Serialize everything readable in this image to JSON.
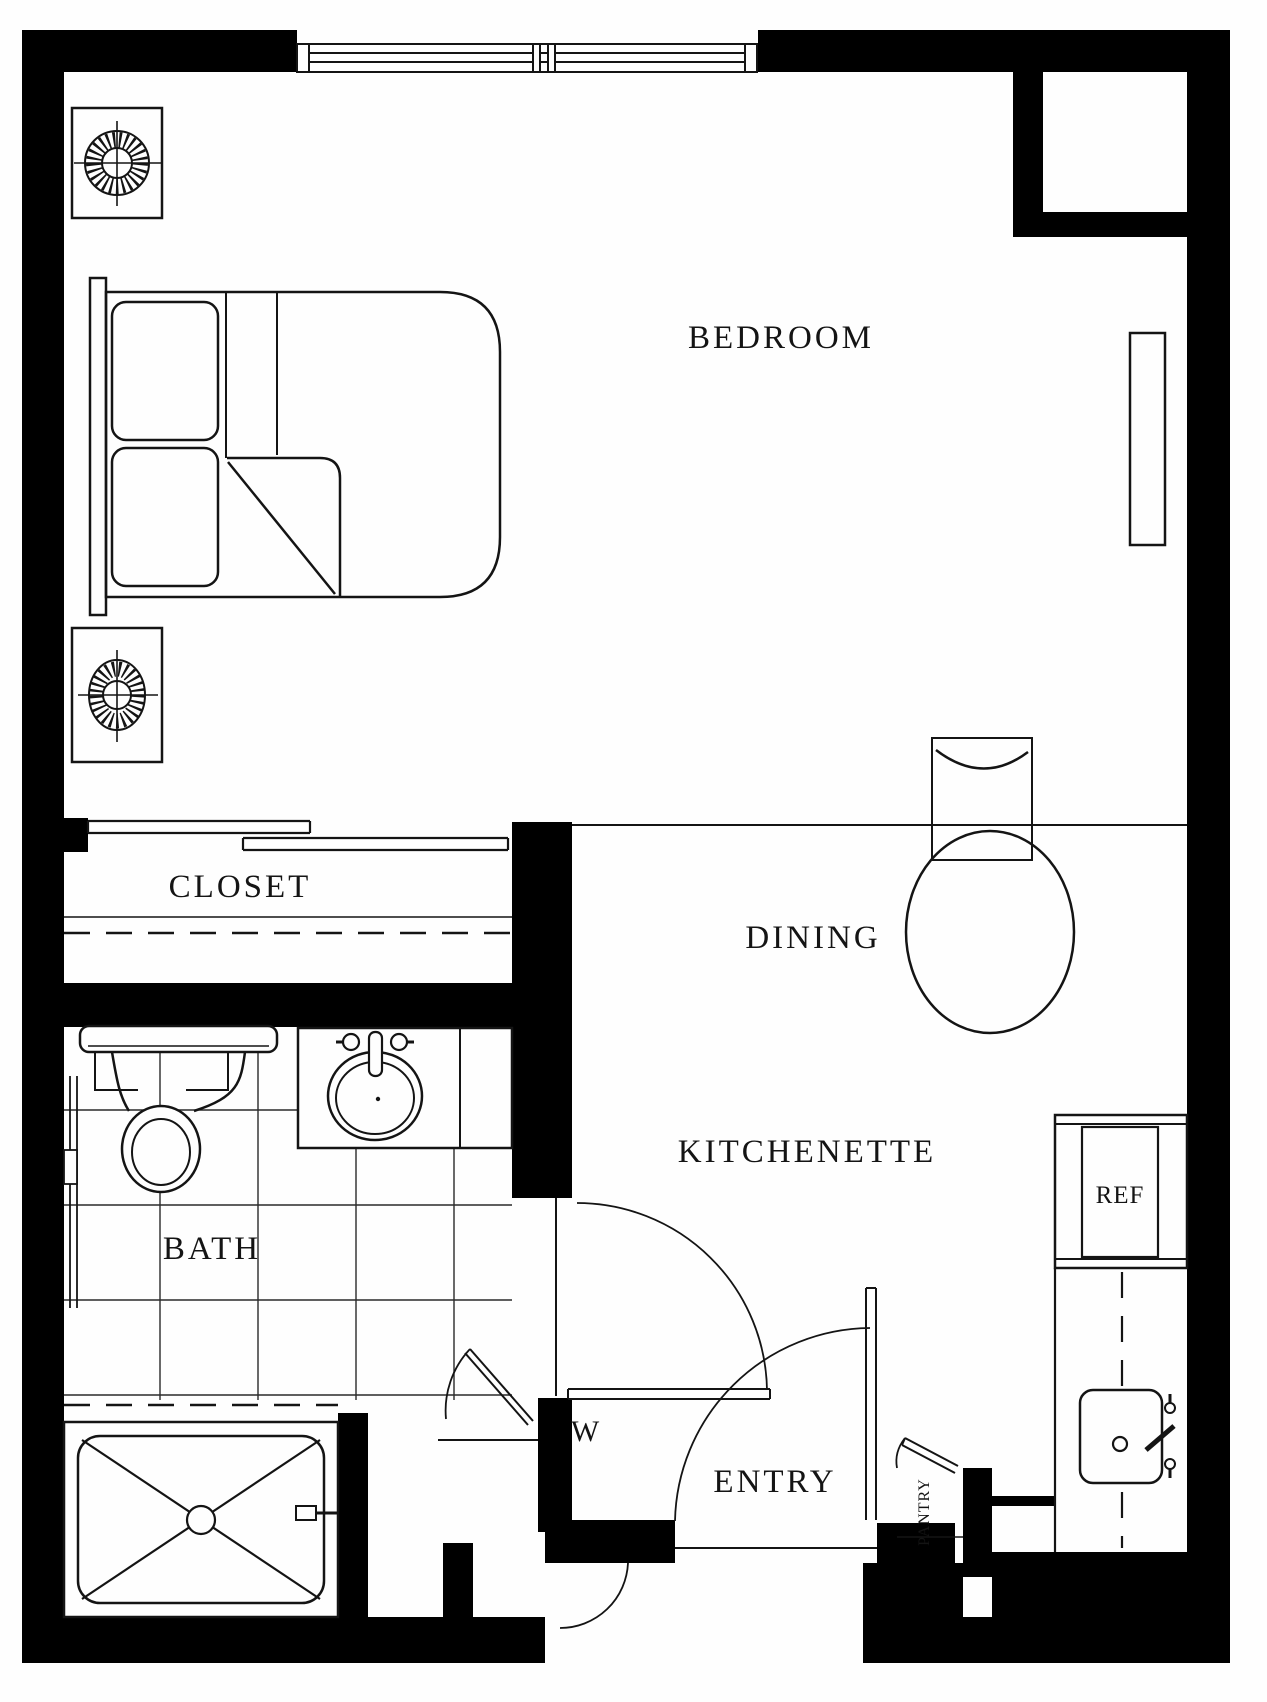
{
  "document_type": "apartment floor plan (studio unit)",
  "labels": {
    "bedroom": "BEDROOM",
    "closet": "CLOSET",
    "dining": "DINING",
    "bath": "BATH",
    "kitchenette": "KITCHENETTE",
    "entry": "ENTRY",
    "ref": "REF",
    "pantry": "PANTRY",
    "w_marker": "W"
  },
  "colors": {
    "paper": "#fefefe",
    "ink": "#141414",
    "wall": "#000000"
  },
  "symbols": [
    "double-bed-with-pillows-and-turned-blanket",
    "nightstand-with-lamp (x2)",
    "sliding-bypass-closet-doors",
    "closet-rod-dashed-line",
    "round-dining-table-with-chair",
    "toilet",
    "vanity-sink",
    "grab-bar",
    "tiled-floor-grid",
    "shower-pan-with-x-and-drain",
    "door-swing-arcs (bath, hall, entry, pantry)",
    "refrigerator",
    "kitchen-counter-with-sink",
    "window-with-mullions",
    "wall-niche-column"
  ]
}
